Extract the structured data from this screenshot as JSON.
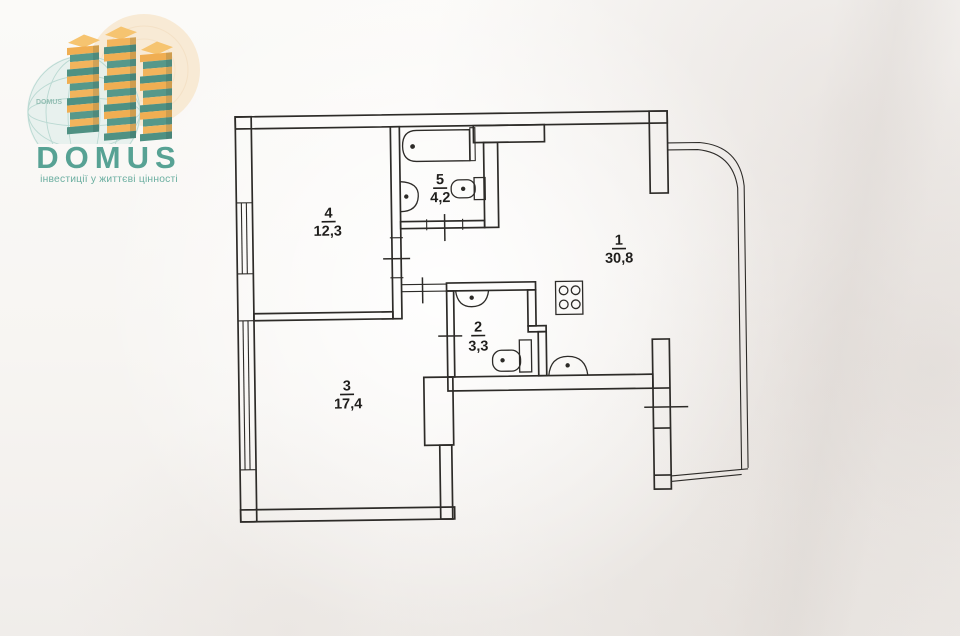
{
  "brand": {
    "name": "DOMUS",
    "tagline": "інвестиції у життєві цінності",
    "globe_watermark": "DOMUS"
  },
  "plan": {
    "type": "apartment-floor-plan",
    "rooms": [
      {
        "id": "1",
        "area": "30,8"
      },
      {
        "id": "2",
        "area": "3,3"
      },
      {
        "id": "3",
        "area": "17,4"
      },
      {
        "id": "4",
        "area": "12,3"
      },
      {
        "id": "5",
        "area": "4,2"
      }
    ],
    "icons": [
      "bathtub-icon",
      "bathroom-sink-icon",
      "bathroom-toilet-icon",
      "wc-sink-icon",
      "wc-toilet-icon",
      "stove-icon",
      "kitchen-sink-icon",
      "window-icon",
      "door-mark-icon",
      "balcony-glazing-icon"
    ]
  },
  "colors": {
    "ink": "#2d2b28",
    "paper": "#f6f4f1",
    "brand_teal": "#57a294",
    "brand_teal_light": "#6cafa1",
    "brand_orange": "#f0ae52",
    "brand_orange_light": "#f6c470",
    "globe_mint": "#e4f0ec",
    "circle_peach": "#f8e6cc"
  }
}
